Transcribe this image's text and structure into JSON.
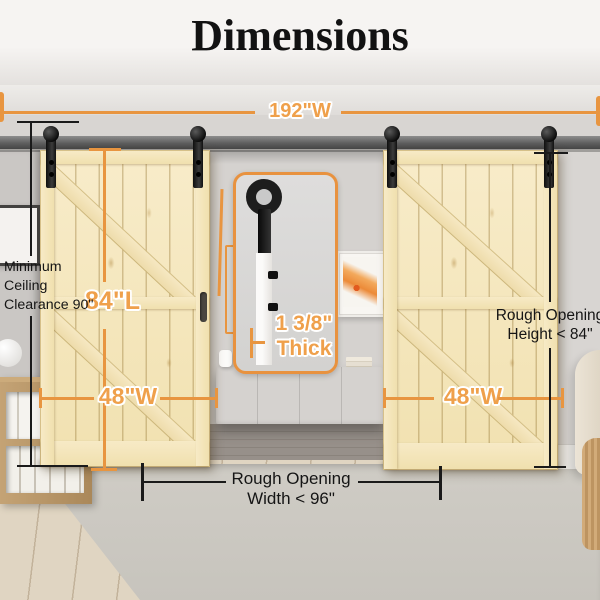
{
  "title": "Dimensions",
  "labels": {
    "track_width": "192\"W",
    "door_length": "84\"L",
    "door_width_left": "48\"W",
    "door_width_right": "48\"W",
    "thickness_value": "1 3/8\"",
    "thickness_word": "Thick",
    "ceiling_clearance": [
      "Minimum",
      "Ceiling",
      "Clearance 90\""
    ],
    "rough_opening_height": [
      "Rough Opening",
      "Height < 84\""
    ],
    "rough_opening_width": [
      "Rough Opening",
      "Width < 96\""
    ]
  },
  "colors": {
    "accent_orange": "#E8923F",
    "measurement_black": "#1A1A1A",
    "door_wood": "#F5E8C2"
  }
}
